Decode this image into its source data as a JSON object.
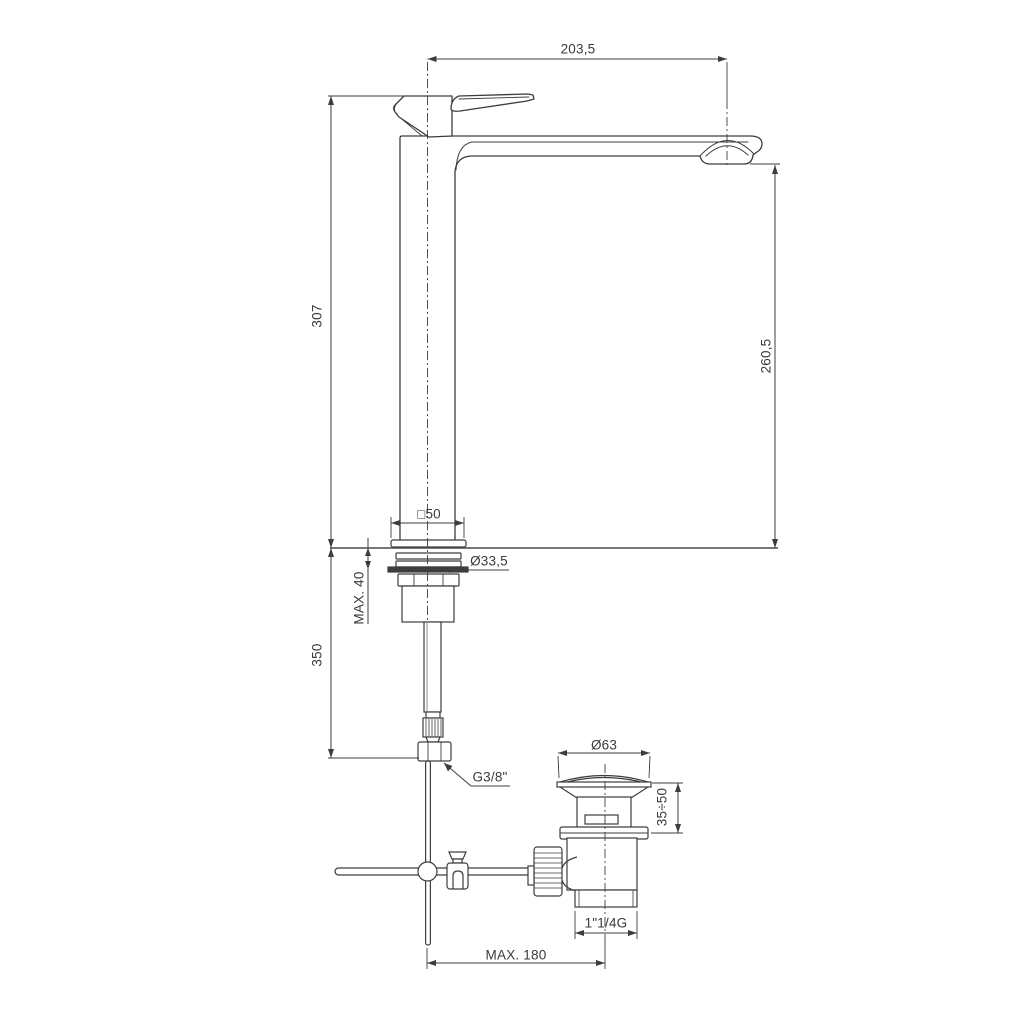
{
  "drawing": {
    "background_color": "#ffffff",
    "line_color": "#3d3d3d",
    "dimensions": {
      "spout_reach": "203,5",
      "total_height": "307",
      "spout_height": "260,5",
      "base_width": "□50",
      "shank_thread_diameter": "Ø33,5",
      "max_deck_thickness": "MAX. 40",
      "hose_drop": "350",
      "supply_connection": "G3/8\"",
      "waste_cap_diameter": "Ø63",
      "waste_adjust_range": "35÷50",
      "waste_thread": "1\"1/4G",
      "max_rod_reach": "MAX. 180"
    }
  }
}
